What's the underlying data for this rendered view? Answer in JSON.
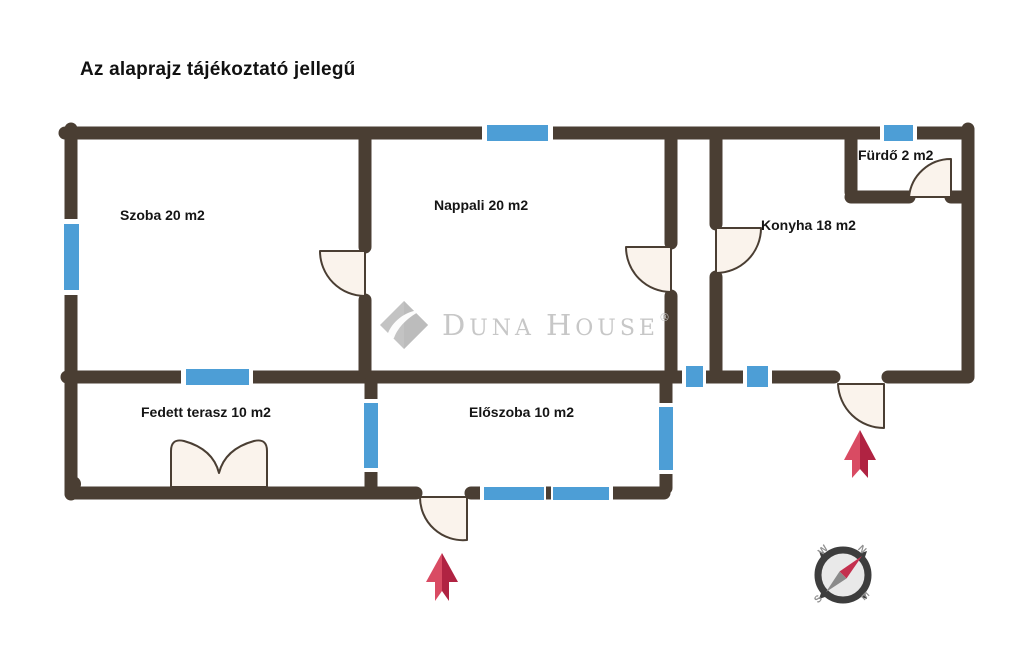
{
  "disclaimer": "Az alaprajz tájékoztató jellegű",
  "watermark": {
    "brand": "Duna House",
    "text_parts": {
      "d": "D",
      "una": "UNA",
      "space": " ",
      "h": "H",
      "ouse": "OUSE"
    },
    "registered_mark": "®"
  },
  "rooms": {
    "szoba": {
      "label": "Szoba 20 m2"
    },
    "nappali": {
      "label": "Nappali 20 m2"
    },
    "furdo": {
      "label": "Fürdő 2 m2"
    },
    "konyha": {
      "label": "Konyha 18 m2"
    },
    "fedett_terasz": {
      "label": "Fedett terasz 10 m2"
    },
    "eloszoba": {
      "label": "Előszoba 10 m2"
    }
  },
  "compass": {
    "north": "N",
    "south": "S",
    "east": "E",
    "west": "W"
  },
  "colors": {
    "wall": "#4a3e33",
    "window_blue": "#4d9ed6",
    "door_fill": "#faf3ec",
    "arrow_red_light": "#d94b63",
    "arrow_red_dark": "#b02342",
    "watermark_gray": "#c7c7c7",
    "compass_ring": "#3d3d3d",
    "compass_face": "#e9e9e9",
    "needle_red": "#c4304e",
    "needle_gray": "#8a8a8a"
  }
}
